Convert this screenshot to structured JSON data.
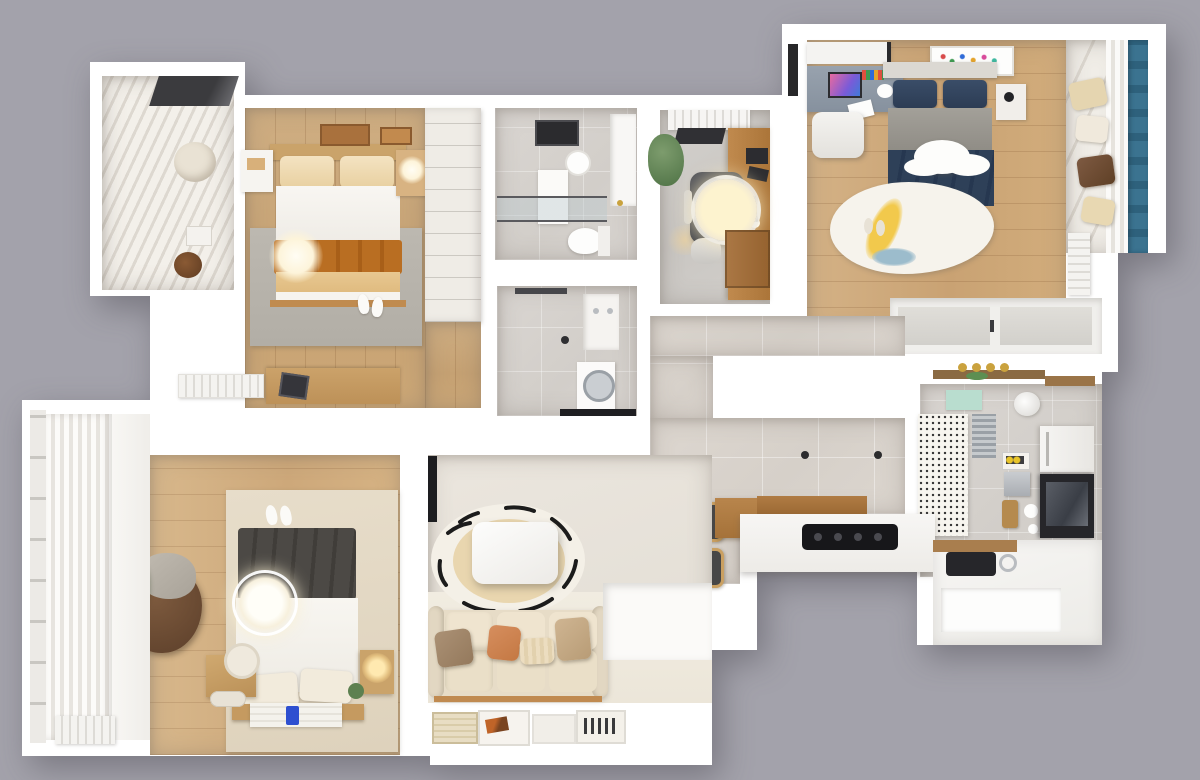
{
  "watermark": {
    "brand_zh": "红牛装饰",
    "brand_en": "HONG NIU DECORATION",
    "registered_mark": "®"
  },
  "palette": {
    "background_gray": "#a3a2ab",
    "wall_white": "#ffffff",
    "wood_floor": "#cba87c",
    "tile_floor": "#d8d2cb",
    "teal_curtain": "#38718a",
    "rust_blanket": "#b96e22",
    "navy_duvet": "#2e4058",
    "sofa_cream": "#e9decb",
    "cooktop_black": "#17171a"
  }
}
